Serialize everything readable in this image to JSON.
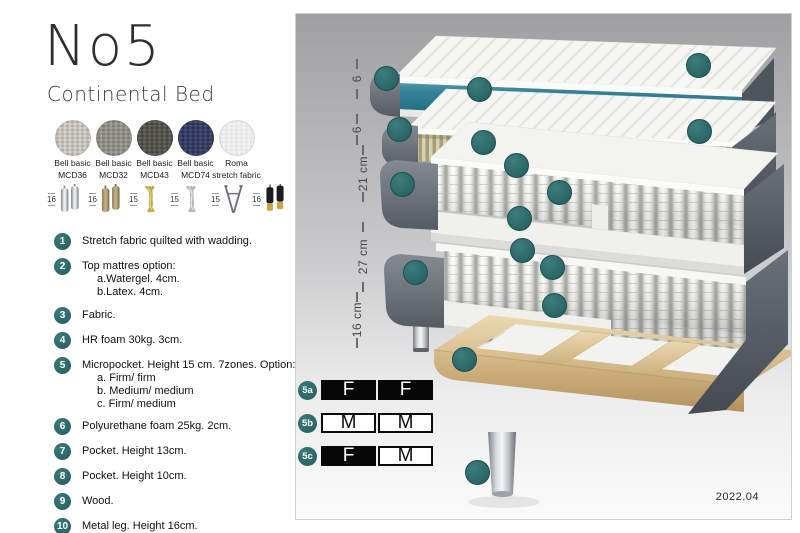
{
  "header": {
    "title": "No5",
    "subtitle": "Continental Bed"
  },
  "fabric_swatches": [
    {
      "name": "Bell basic",
      "code": "MCD36",
      "color": "#d8d6d0",
      "dot": "#b2afa7"
    },
    {
      "name": "Bell basic",
      "code": "MCD32",
      "color": "#a3a19c",
      "dot": "#807e78"
    },
    {
      "name": "Bell basic",
      "code": "MCD43",
      "color": "#454440",
      "dot": "#64635d"
    },
    {
      "name": "Bell basic",
      "code": "MCD74",
      "color": "#2b3150",
      "dot": "#454d75"
    },
    {
      "name": "Roma",
      "code": "stretch fabric",
      "color": "#f2f2f2",
      "dot": "#e6e6e6"
    }
  ],
  "leg_options": [
    {
      "height": "16",
      "type": "cylinder-silver"
    },
    {
      "height": "16",
      "type": "cylinder-wood"
    },
    {
      "height": "15",
      "type": "twist-gold"
    },
    {
      "height": "15",
      "type": "twist-silver"
    },
    {
      "height": "15",
      "type": "hairpin"
    },
    {
      "height": "16",
      "type": "cylinder-black-gold"
    }
  ],
  "legend": [
    {
      "num": "1",
      "lines": [
        "Stretch fabric quilted with wadding."
      ]
    },
    {
      "num": "2",
      "lines": [
        "Top mattres option:",
        "a.Watergel. 4cm.",
        "b.Latex. 4cm."
      ]
    },
    {
      "num": "3",
      "lines": [
        "Fabric."
      ]
    },
    {
      "num": "4",
      "lines": [
        "HR foam 30kg. 3cm."
      ]
    },
    {
      "num": "5",
      "lines": [
        "Micropocket. Height 15 cm. 7zones. Option:",
        "a. Firm/ firm",
        "b. Medium/ medium",
        "c. Firm/ medium"
      ]
    },
    {
      "num": "6",
      "lines": [
        "Polyurethane foam 25kg. 2cm."
      ]
    },
    {
      "num": "7",
      "lines": [
        "Pocket. Height 13cm."
      ]
    },
    {
      "num": "8",
      "lines": [
        "Pocket. Height 10cm."
      ]
    },
    {
      "num": "9",
      "lines": [
        "Wood."
      ]
    },
    {
      "num": "10",
      "lines": [
        "Metal leg. Height 16cm."
      ]
    }
  ],
  "diagram": {
    "measurements": [
      {
        "label": "6"
      },
      {
        "label": "6"
      },
      {
        "label": "21 cm"
      },
      {
        "label": "27 cm"
      },
      {
        "label": "16 cm"
      }
    ],
    "labels": [
      {
        "text": "3",
        "x": 90,
        "y": 64
      },
      {
        "text": "2a",
        "x": 183,
        "y": 75
      },
      {
        "text": "1",
        "x": 402,
        "y": 51
      },
      {
        "text": "3",
        "x": 103,
        "y": 115
      },
      {
        "text": "2b",
        "x": 187,
        "y": 128
      },
      {
        "text": "1",
        "x": 403,
        "y": 117
      },
      {
        "text": "4",
        "x": 220,
        "y": 151
      },
      {
        "text": "3",
        "x": 106,
        "y": 170
      },
      {
        "text": "5",
        "x": 263,
        "y": 178
      },
      {
        "text": "4",
        "x": 223,
        "y": 204
      },
      {
        "text": "6",
        "x": 226,
        "y": 236
      },
      {
        "text": "3",
        "x": 119,
        "y": 258
      },
      {
        "text": "7",
        "x": 256,
        "y": 253
      },
      {
        "text": "8",
        "x": 258,
        "y": 291
      },
      {
        "text": "9",
        "x": 168,
        "y": 345
      },
      {
        "text": "10",
        "x": 181,
        "y": 458
      }
    ],
    "firmness_options": [
      {
        "label": "5a",
        "cells": [
          {
            "text": "F",
            "filled": true
          },
          {
            "text": "F",
            "filled": true
          }
        ]
      },
      {
        "label": "5b",
        "cells": [
          {
            "text": "M",
            "filled": false
          },
          {
            "text": "M",
            "filled": false
          }
        ]
      },
      {
        "label": "5c",
        "cells": [
          {
            "text": "F",
            "filled": true
          },
          {
            "text": "M",
            "filled": false
          }
        ]
      }
    ],
    "version": "2022.04"
  }
}
